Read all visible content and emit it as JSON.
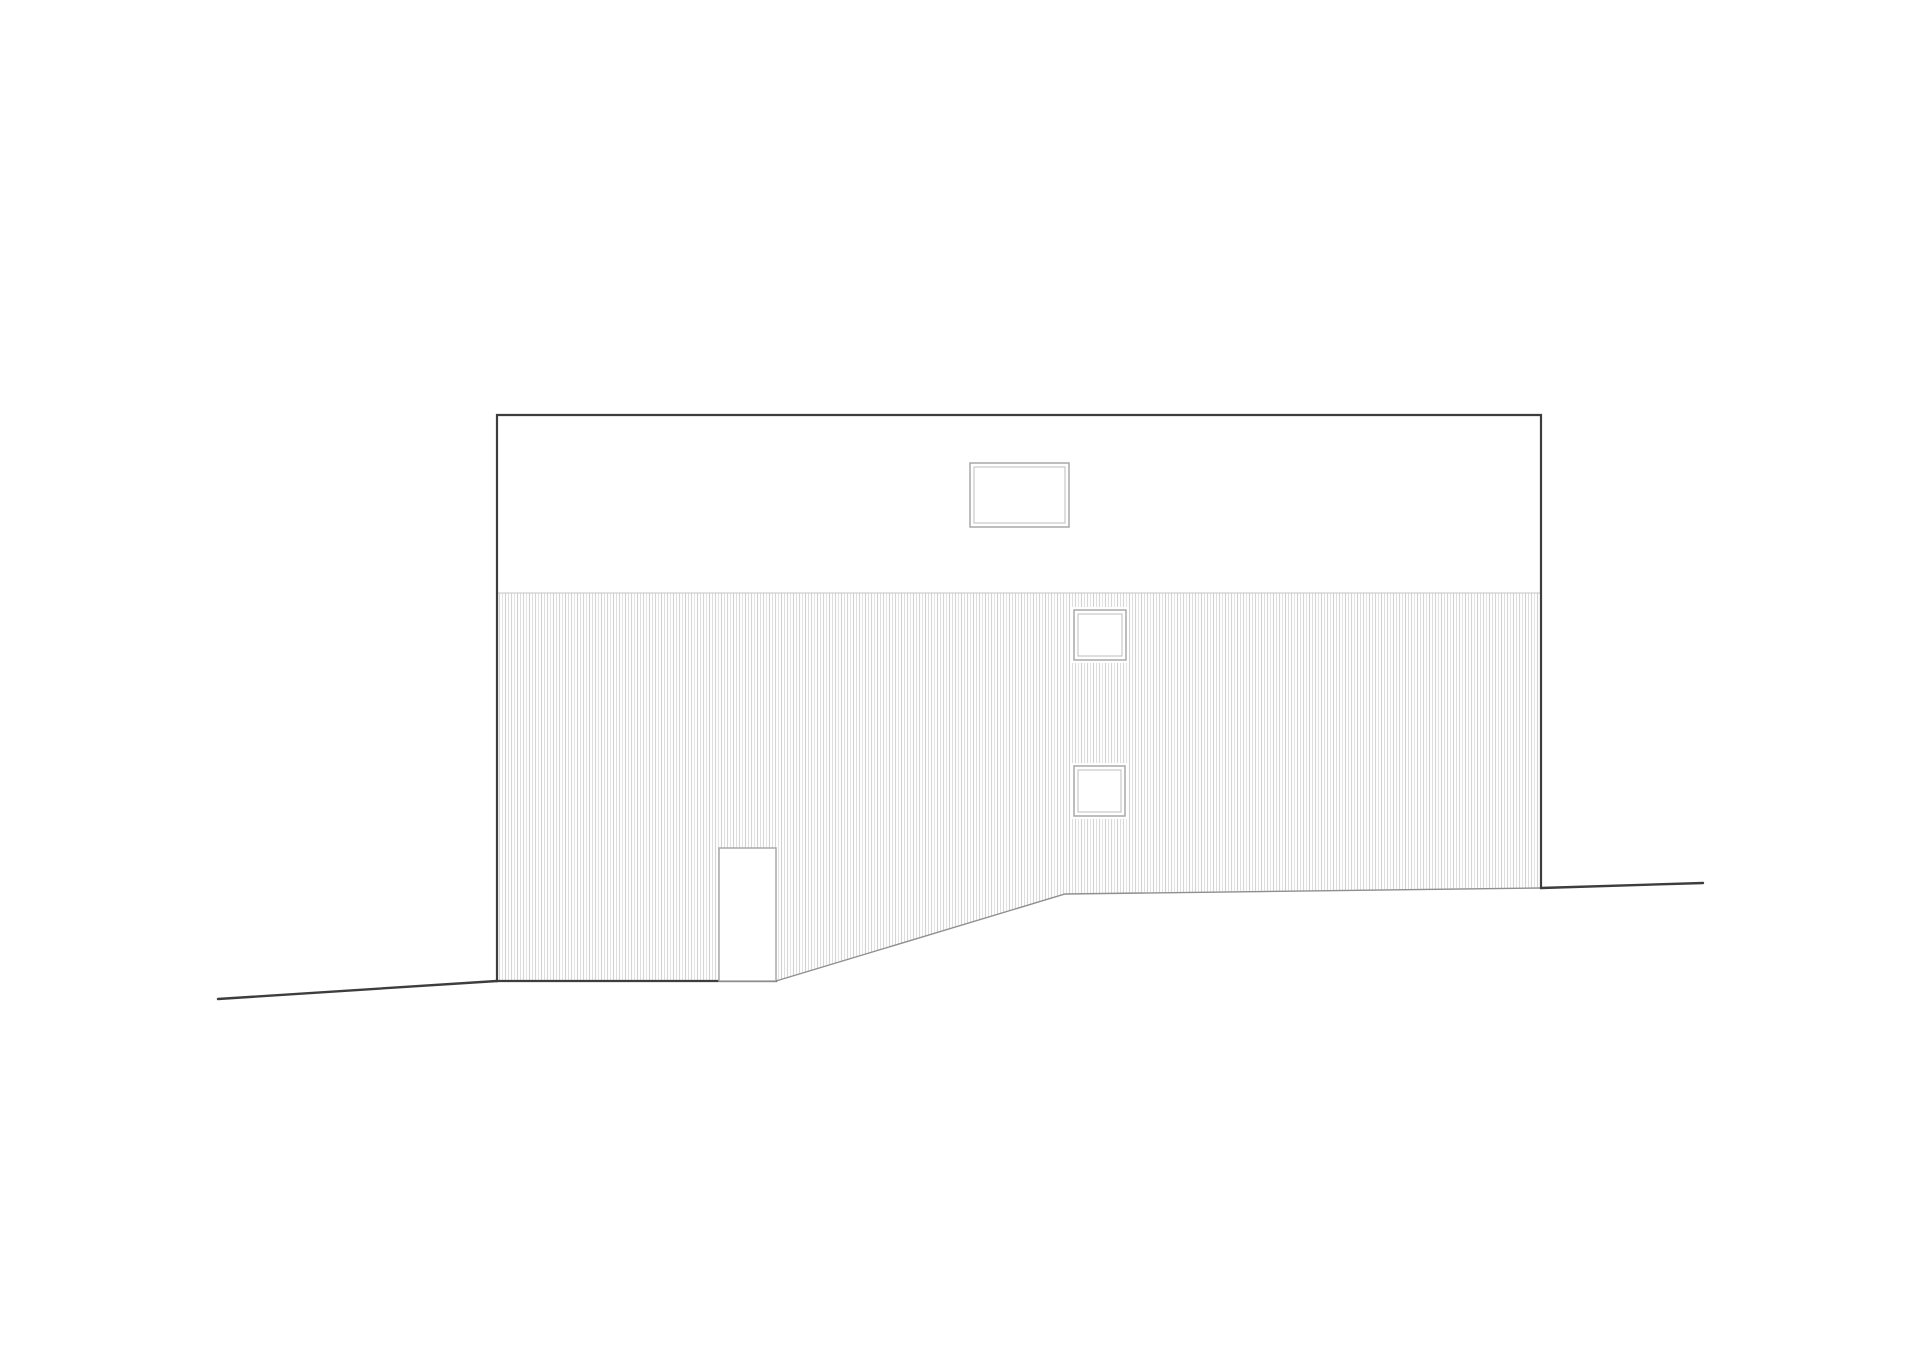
{
  "drawing": {
    "kind": "architectural-side-elevation",
    "elements": {
      "upper_wall": "plain upper wall band",
      "lower_wall": "vertically corrugated wall cladding",
      "clerestory_window": "wide double-framed window in upper band",
      "square_window_upper": "small square window",
      "square_window_lower": "small square window",
      "door": "tall narrow door at lower left",
      "ground_left": "ground line sloping down to the left",
      "ground_right": "ground line extending to the right"
    },
    "counts": {
      "windows": 3,
      "doors": 1
    }
  },
  "palette": {
    "background": "#ffffff",
    "outline": "#3d3d3d",
    "secondary_line": "#8f8f8f",
    "divider_line": "#c6c6c6",
    "frame": "#a8a8a8",
    "frame_light": "#bdbdbd",
    "hatch_line_a": "#d2d2d2",
    "hatch_line_b": "#dedede",
    "hatch_line_c": "#d6d6d6",
    "hatch_line_d": "#e3e3e3"
  }
}
